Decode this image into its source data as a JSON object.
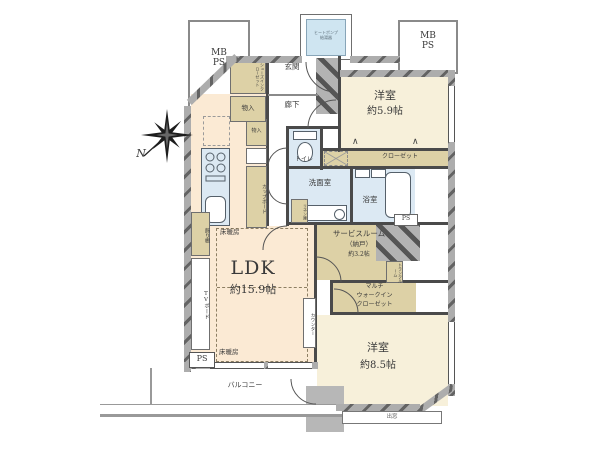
{
  "plan_title": "apartment-floor-plan",
  "rooms": {
    "ldk": {
      "name": "LDK",
      "size": "約15.9帖"
    },
    "bedroom_59": {
      "name": "洋室",
      "size": "約5.9帖"
    },
    "bedroom_85": {
      "name": "洋室",
      "size": "約8.5帖"
    },
    "service_room": {
      "l1": "サービスルーム",
      "l2": "（納戸）",
      "l3": "約3.2帖"
    },
    "entrance": "玄関",
    "hallway": "廊下",
    "toilet": "トイレ",
    "washroom": "洗面室",
    "bathroom": "浴室",
    "balcony": "バルコニー"
  },
  "storage": {
    "shoes_in_closet": "シューズインクローゼット",
    "storage_entry": "物入",
    "storage_kitchen": "物入",
    "cupboard": "カップボード",
    "closet": "クローゼット",
    "multi_wic": {
      "l1": "マルチ",
      "l2": "ウォークイン",
      "l3": "クローゼット"
    },
    "linen": "リネン庫",
    "trunk_room": "トランクルーム"
  },
  "equipment": {
    "heat_pump_l1": "ヒートポンプ",
    "heat_pump_l2": "給湯器",
    "floor_heating_upper": "床暖房",
    "floor_heating_lower": "床暖房",
    "counter": "カウンター",
    "tv_board": "TVボード",
    "display_shelf": "飾り棚",
    "bay_window": "出窓"
  },
  "shafts": {
    "mb_ps_left": {
      "l1": "MB",
      "l2": "PS"
    },
    "mb_ps_right": {
      "l1": "MB",
      "l2": "PS"
    },
    "ps_ldk": "PS",
    "ps_bath": "PS"
  },
  "compass": {
    "north": "N"
  },
  "icons": {
    "hanger": "∧"
  },
  "colors": {
    "floor_cream": "#f7f0da",
    "floor_ldk": "#fbead4",
    "storage_tan": "#ddd1a6",
    "wet_blue": "#dce9f3",
    "heat_pump_blue": "#cfe5f1",
    "wall_gray": "#ababab",
    "wall_dark": "#4a4a4a"
  }
}
